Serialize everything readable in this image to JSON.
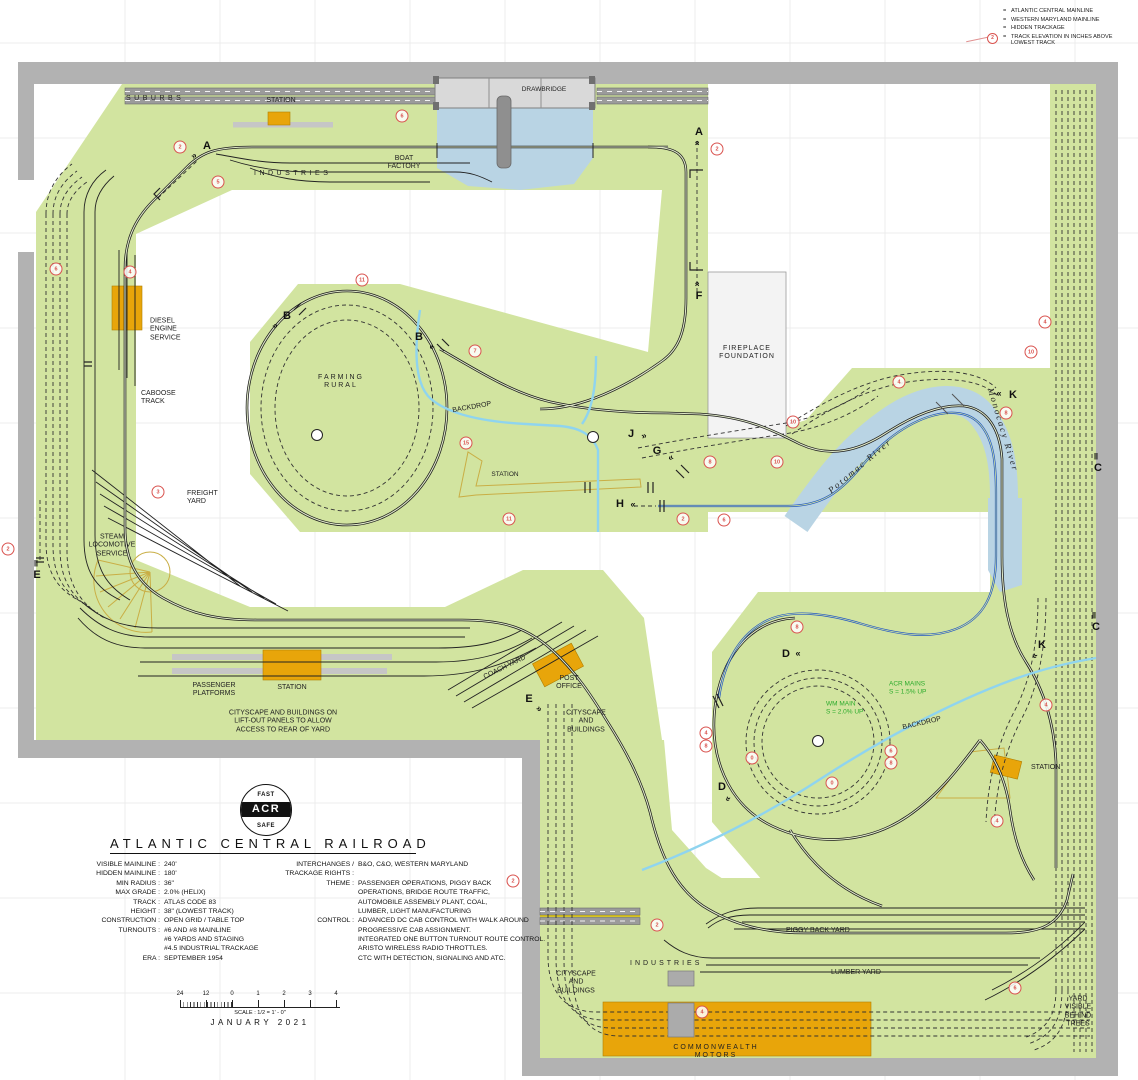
{
  "colors": {
    "benchwork_green": "#d2e4a0",
    "wall_gray": "#b2b2b2",
    "water_blue": "#b9d4e4",
    "track_black": "#1b1b1b",
    "wm_blue": "#2257c4",
    "hidden_track": "#333333",
    "backdrop_cyan": "#8fd4ef",
    "elevation_red": "#d9534f",
    "building_orange": "#e8a50a",
    "annotation_green": "#2cab2c",
    "road_gray": "#9b9b9b"
  },
  "legend": {
    "items": [
      {
        "name": "acr-mainline",
        "label": "ATLANTIC CENTRAL MAINLINE",
        "style": "solid-dark"
      },
      {
        "name": "wm-mainline",
        "label": "WESTERN MARYLAND MAINLINE",
        "style": "solid-blue"
      },
      {
        "name": "hidden-trackage",
        "label": "HIDDEN TRACKAGE",
        "style": "dashed"
      },
      {
        "name": "track-elevation",
        "label": "TRACK ELEVATION IN INCHES ABOVE LOWEST TRACK",
        "style": "elevation",
        "sample_value": "2"
      }
    ]
  },
  "logo": {
    "top": "FAST",
    "center": "ACR",
    "bottom": "SAFE"
  },
  "title_block": {
    "title": "ATLANTIC CENTRAL RAILROAD",
    "left_specs": [
      {
        "label": "VISIBLE MAINLINE :",
        "value": "240'"
      },
      {
        "label": "HIDDEN MAINLINE :",
        "value": "180'"
      },
      {
        "label": "MIN RADIUS :",
        "value": "36\""
      },
      {
        "label": "MAX GRADE :",
        "value": "2.0% (HELIX)"
      },
      {
        "label": "TRACK :",
        "value": "ATLAS CODE 83"
      },
      {
        "label": "HEIGHT :",
        "value": "38\" (LOWEST TRACK)"
      },
      {
        "label": "CONSTRUCTION :",
        "value": "OPEN GRID / TABLE TOP"
      },
      {
        "label": "TURNOUTS :",
        "value": "#6 AND #8 MAINLINE"
      },
      {
        "label": "",
        "value": "#6 YARDS AND STAGING"
      },
      {
        "label": "",
        "value": "#4.5 INDUSTRIAL TRACKAGE"
      },
      {
        "label": "ERA :",
        "value": "SEPTEMBER 1954"
      }
    ],
    "right_specs": [
      {
        "label": "INTERCHANGES /\nTRACKAGE RIGHTS :",
        "value": "B&O, C&O, WESTERN MARYLAND"
      },
      {
        "label": "THEME :",
        "value": "PASSENGER OPERATIONS, PIGGY BACK\nOPERATIONS, BRIDGE ROUTE TRAFFIC,\nAUTOMOBILE ASSEMBLY PLANT, COAL,\nLUMBER, LIGHT MANUFACTURING"
      },
      {
        "label": "CONTROL :",
        "value": "ADVANCED DC CAB CONTROL WITH WALK AROUND\nPROGRESSIVE CAB ASSIGNMENT.\nINTEGRATED ONE BUTTON TURNOUT ROUTE CONTROL.\nARISTO WIRELESS RADIO THROTTLES.\nCTC WITH DETECTION, SIGNALING AND ATC."
      }
    ]
  },
  "scale_bar": {
    "ticks": [
      "24",
      "12",
      "0",
      "1",
      "2",
      "3",
      "4"
    ],
    "scale_text": "SCALE : 1/2 = 1' - 0\"",
    "date": "JANUARY 2021"
  },
  "map": {
    "labels": [
      {
        "name": "label-suburbs",
        "lines": [
          "SUBURBS"
        ],
        "x": 126,
        "y": 99,
        "align": "left",
        "ls": 3.5
      },
      {
        "name": "label-station-top",
        "lines": [
          "STATION"
        ],
        "x": 281,
        "y": 101,
        "align": "center"
      },
      {
        "name": "label-industries",
        "lines": [
          "INDUSTRIES"
        ],
        "x": 254,
        "y": 174,
        "align": "left",
        "ls": 3.5
      },
      {
        "name": "label-boat-factory",
        "lines": [
          "BOAT",
          "FACTORY"
        ],
        "x": 404,
        "y": 163,
        "align": "center"
      },
      {
        "name": "label-drawbridge",
        "lines": [
          "DRAWBRIDGE"
        ],
        "x": 544,
        "y": 90,
        "align": "center",
        "fs": 6.5
      },
      {
        "name": "label-diesel-engine-service",
        "lines": [
          "DIESEL",
          "ENGINE",
          "SERVICE"
        ],
        "x": 150,
        "y": 330,
        "align": "left"
      },
      {
        "name": "label-caboose-track",
        "lines": [
          "CABOOSE",
          "TRACK"
        ],
        "x": 141,
        "y": 398,
        "align": "left"
      },
      {
        "name": "label-freight-yard",
        "lines": [
          "FREIGHT",
          "YARD"
        ],
        "x": 187,
        "y": 498,
        "align": "left"
      },
      {
        "name": "label-steam-locomotive-service",
        "lines": [
          "STEAM",
          "LOCOMOTIVE",
          "SERVICE"
        ],
        "x": 112,
        "y": 546,
        "align": "center"
      },
      {
        "name": "label-farming-rural",
        "lines": [
          "FARMING",
          "RURAL"
        ],
        "x": 341,
        "y": 382,
        "align": "center",
        "ls": 2
      },
      {
        "name": "label-backdrop-1",
        "lines": [
          "BACKDROP"
        ],
        "x": 472,
        "y": 408,
        "align": "center",
        "rot": -10
      },
      {
        "name": "label-station-center",
        "lines": [
          "STATION"
        ],
        "x": 505,
        "y": 475,
        "align": "center",
        "fs": 6.5
      },
      {
        "name": "label-fireplace-foundation",
        "lines": [
          "FIREPLACE",
          "FOUNDATION"
        ],
        "x": 747,
        "y": 353,
        "align": "center",
        "ls": 1
      },
      {
        "name": "label-potomac-river",
        "lines": [
          "Potomac River"
        ],
        "x": 860,
        "y": 466,
        "align": "center",
        "rot": -40,
        "italic": true,
        "fs": 9,
        "ls": 2
      },
      {
        "name": "label-monocacy-river",
        "lines": [
          "Monocacy River"
        ],
        "x": 1003,
        "y": 430,
        "align": "center",
        "rot": 73,
        "italic": true,
        "fs": 9,
        "ls": 2
      },
      {
        "name": "label-passenger-platforms",
        "lines": [
          "PASSENGER",
          "PLATFORMS"
        ],
        "x": 214,
        "y": 690,
        "align": "center"
      },
      {
        "name": "label-station-bl",
        "lines": [
          "STATION"
        ],
        "x": 292,
        "y": 688,
        "align": "center"
      },
      {
        "name": "label-coach-yard",
        "lines": [
          "COACH YARD"
        ],
        "x": 505,
        "y": 668,
        "align": "center",
        "rot": -26
      },
      {
        "name": "label-post-office",
        "lines": [
          "POST",
          "OFFICE"
        ],
        "x": 569,
        "y": 683,
        "align": "center"
      },
      {
        "name": "label-cityscape-1",
        "lines": [
          "CITYSCAPE",
          "AND",
          "BUILDINGS"
        ],
        "x": 586,
        "y": 722,
        "align": "center"
      },
      {
        "name": "label-liftout-note",
        "lines": [
          "CITYSCAPE AND BUILDINGS ON",
          "LIFT-OUT PANELS TO ALLOW",
          "ACCESS TO REAR OF YARD"
        ],
        "x": 283,
        "y": 722,
        "align": "center"
      },
      {
        "name": "label-backdrop-2",
        "lines": [
          "BACKDROP"
        ],
        "x": 922,
        "y": 724,
        "align": "center",
        "rot": -13
      },
      {
        "name": "label-wm-main-grade",
        "lines": [
          "WM MAIN",
          "S = 2.0% UP"
        ],
        "x": 826,
        "y": 708,
        "align": "left",
        "color": "#2cab2c",
        "fs": 6.5
      },
      {
        "name": "label-acr-mains-grade",
        "lines": [
          "ACR MAINS",
          "S = 1.5% UP"
        ],
        "x": 889,
        "y": 688,
        "align": "left",
        "color": "#2cab2c",
        "fs": 6.5
      },
      {
        "name": "label-station-br",
        "lines": [
          "STATION"
        ],
        "x": 1031,
        "y": 768,
        "align": "left"
      },
      {
        "name": "label-cityscape-2",
        "lines": [
          "CITYSCAPE",
          "AND",
          "BUILDINGS"
        ],
        "x": 576,
        "y": 983,
        "align": "center"
      },
      {
        "name": "label-industries-2",
        "lines": [
          "INDUSTRIES"
        ],
        "x": 630,
        "y": 964,
        "align": "left",
        "ls": 3
      },
      {
        "name": "label-piggy-back-yard",
        "lines": [
          "PIGGY BACK YARD"
        ],
        "x": 786,
        "y": 931,
        "align": "left"
      },
      {
        "name": "label-lumber-yard",
        "lines": [
          "LUMBER YARD"
        ],
        "x": 831,
        "y": 973,
        "align": "left"
      },
      {
        "name": "label-commonwealth-motors",
        "lines": [
          "COMMONWEALTH",
          "MOTORS"
        ],
        "x": 716,
        "y": 1052,
        "align": "center",
        "ls": 2
      },
      {
        "name": "label-yard-trees",
        "lines": [
          "YARD",
          "VISIBLE",
          "BEHIND",
          "TREES"
        ],
        "x": 1078,
        "y": 1012,
        "align": "center"
      }
    ],
    "section_markers": [
      {
        "t": "A",
        "x": 207,
        "y": 146,
        "ax": -13,
        "ay": 10,
        "rot": -38,
        "ch": "»"
      },
      {
        "t": "A",
        "x": 699,
        "y": 132,
        "ax": -2,
        "ay": 11,
        "rot": -90,
        "ch": "»"
      },
      {
        "t": "F",
        "x": 699,
        "y": 296,
        "ax": -2,
        "ay": -12,
        "rot": -90,
        "ch": "»"
      },
      {
        "t": "B",
        "x": 287,
        "y": 316,
        "ax": -12,
        "ay": 10,
        "rot": -38,
        "ch": "»"
      },
      {
        "t": "B",
        "x": 419,
        "y": 337,
        "ax": 13,
        "ay": 10,
        "rot": 142,
        "ch": "»"
      },
      {
        "t": "C",
        "x": 1098,
        "y": 468,
        "ax": -2,
        "ay": -11,
        "rot": 0,
        "ch": "‖"
      },
      {
        "t": "C",
        "x": 1096,
        "y": 627,
        "ax": -2,
        "ay": -11,
        "rot": 0,
        "ch": "‖"
      },
      {
        "t": "D",
        "x": 786,
        "y": 654,
        "ax": 12,
        "ay": 0,
        "rot": 180,
        "ch": "»"
      },
      {
        "t": "D",
        "x": 722,
        "y": 787,
        "ax": 6,
        "ay": 12,
        "rot": 115,
        "ch": "»"
      },
      {
        "t": "E",
        "x": 37,
        "y": 575,
        "ax": -1,
        "ay": -11,
        "rot": 0,
        "ch": "‖"
      },
      {
        "t": "E",
        "x": 529,
        "y": 699,
        "ax": 10,
        "ay": 10,
        "rot": 48,
        "ch": "»"
      },
      {
        "t": "G",
        "x": 657,
        "y": 451,
        "ax": 14,
        "ay": 7,
        "rot": 152,
        "ch": "»"
      },
      {
        "t": "H",
        "x": 620,
        "y": 504,
        "ax": 13,
        "ay": 1,
        "rot": 180,
        "ch": "»"
      },
      {
        "t": "J",
        "x": 631,
        "y": 434,
        "ax": 13,
        "ay": 2,
        "rot": -15,
        "ch": "»"
      },
      {
        "t": "K",
        "x": 1013,
        "y": 395,
        "ax": -14,
        "ay": -1,
        "rot": 180,
        "ch": "»"
      },
      {
        "t": "K",
        "x": 1042,
        "y": 645,
        "ax": -7,
        "ay": 11,
        "rot": 118,
        "ch": "»"
      }
    ],
    "elevation_markers": [
      {
        "v": "2",
        "x": 180,
        "y": 147
      },
      {
        "v": "5",
        "x": 218,
        "y": 182
      },
      {
        "v": "6",
        "x": 402,
        "y": 116
      },
      {
        "v": "6",
        "x": 56,
        "y": 269
      },
      {
        "v": "4",
        "x": 130,
        "y": 272
      },
      {
        "v": "3",
        "x": 158,
        "y": 492
      },
      {
        "v": "2",
        "x": 8,
        "y": 549
      },
      {
        "v": "11",
        "x": 362,
        "y": 280
      },
      {
        "v": "7",
        "x": 475,
        "y": 351
      },
      {
        "v": "15",
        "x": 466,
        "y": 443
      },
      {
        "v": "11",
        "x": 509,
        "y": 519
      },
      {
        "v": "2",
        "x": 683,
        "y": 519
      },
      {
        "v": "6",
        "x": 724,
        "y": 520
      },
      {
        "v": "8",
        "x": 710,
        "y": 462
      },
      {
        "v": "10",
        "x": 777,
        "y": 462
      },
      {
        "v": "10",
        "x": 793,
        "y": 422
      },
      {
        "v": "4",
        "x": 899,
        "y": 382
      },
      {
        "v": "8",
        "x": 1006,
        "y": 413
      },
      {
        "v": "10",
        "x": 1031,
        "y": 352
      },
      {
        "v": "4",
        "x": 1045,
        "y": 322
      },
      {
        "v": "2",
        "x": 717,
        "y": 149
      },
      {
        "v": "8",
        "x": 797,
        "y": 627
      },
      {
        "v": "4",
        "x": 706,
        "y": 733
      },
      {
        "v": "8",
        "x": 706,
        "y": 746
      },
      {
        "v": "0",
        "x": 752,
        "y": 758
      },
      {
        "v": "6",
        "x": 891,
        "y": 751
      },
      {
        "v": "8",
        "x": 891,
        "y": 763
      },
      {
        "v": "0",
        "x": 832,
        "y": 783
      },
      {
        "v": "4",
        "x": 1046,
        "y": 705
      },
      {
        "v": "2",
        "x": 513,
        "y": 881
      },
      {
        "v": "2",
        "x": 657,
        "y": 925
      },
      {
        "v": "4",
        "x": 702,
        "y": 1012
      },
      {
        "v": "4",
        "x": 997,
        "y": 821
      },
      {
        "v": "6",
        "x": 1015,
        "y": 988
      }
    ],
    "o_markers": [
      {
        "x": 317,
        "y": 435
      },
      {
        "x": 593,
        "y": 437
      },
      {
        "x": 818,
        "y": 741
      }
    ]
  }
}
